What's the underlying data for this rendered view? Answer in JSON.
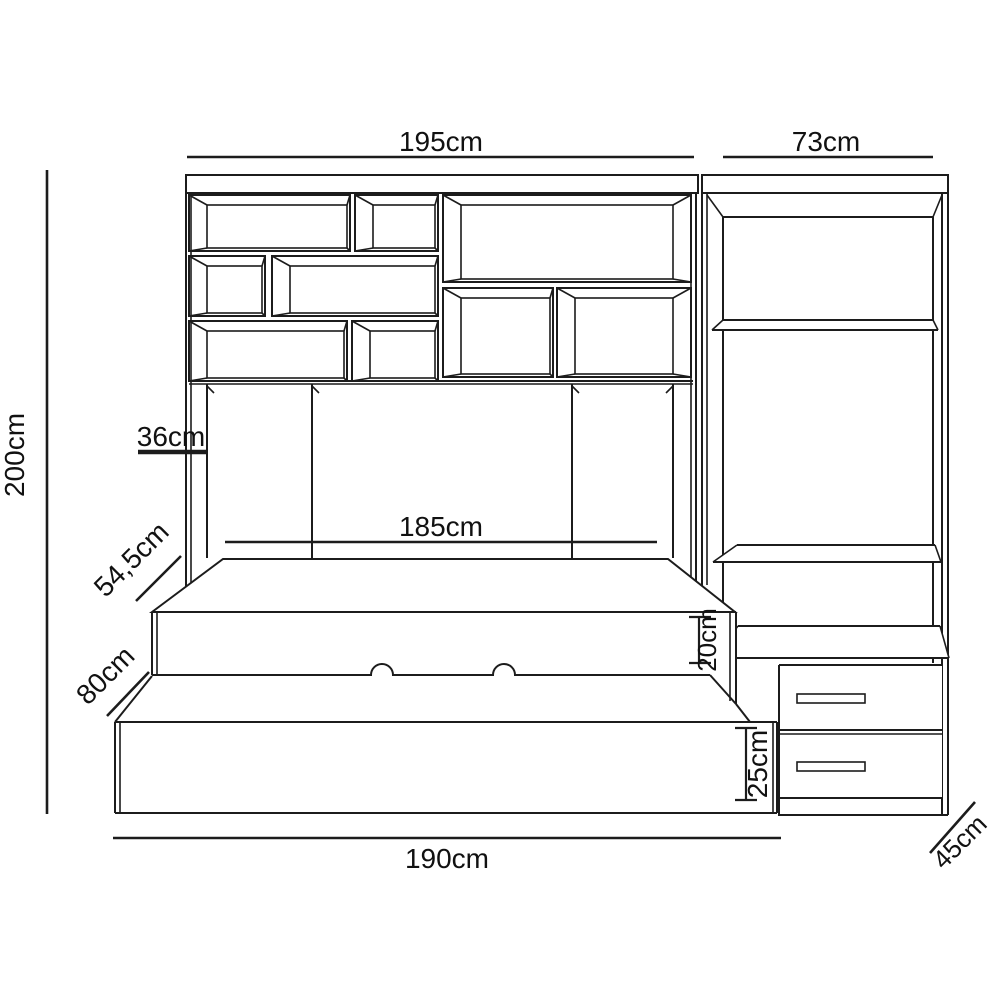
{
  "diagram": {
    "type": "furniture-dimension-drawing",
    "units": "cm",
    "background_color": "#ffffff",
    "line_color": "#1c1c1c",
    "dimensions": {
      "wall_unit_width": "195cm",
      "wardrobe_width": "73cm",
      "total_height": "200cm",
      "alcove_depth": "36cm",
      "bed_inner_length": "185cm",
      "upper_bed_depth": "54,5cm",
      "lower_bed_depth": "80cm",
      "upper_bed_height": "20cm",
      "trundle_height": "25cm",
      "bed_total_length": "190cm",
      "wardrobe_depth": "45cm"
    }
  }
}
